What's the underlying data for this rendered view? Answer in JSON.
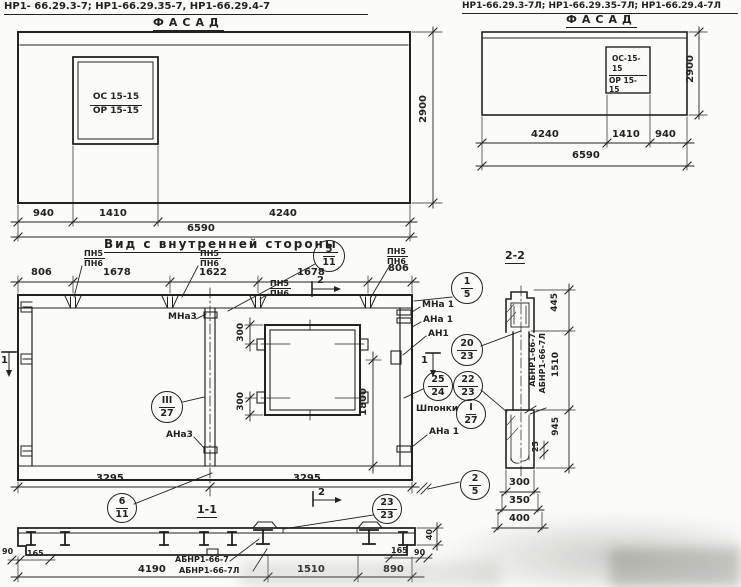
{
  "titles": {
    "left_marks": "НР1- 66.29.3-7;  НР1-66.29.35-7,  НР1-66.29.4-7",
    "right_marks": "НР1-66.29.3-7Л; НР1-66.29.35-7Л; НР1-66.29.4-7Л",
    "facade_left": "ФАСАД",
    "facade_right": "ФАСАД",
    "inner_view": "Вид с внутренней стороны",
    "section1": "1-1",
    "section2": "2-2"
  },
  "facade_left": {
    "window_line1": "ОС 15-15",
    "window_line2": "ОР 15-15",
    "dim_940": "940",
    "dim_1410": "1410",
    "dim_4240": "4240",
    "dim_total": "6590",
    "dim_height": "2900"
  },
  "facade_right": {
    "window_line1": "ОС-15-15",
    "window_line2": "ОР 15-15",
    "dim_4240": "4240",
    "dim_1410": "1410",
    "dim_940": "940",
    "dim_total": "6590",
    "dim_height": "2900"
  },
  "inner": {
    "top_dims": {
      "d1": "806",
      "d2": "1678",
      "d3": "1622",
      "d4": "1678",
      "d5": "806"
    },
    "pn": {
      "top": "ПН5",
      "bottom": "ПН6"
    },
    "bottom_dims": {
      "left": "3295",
      "right": "3295"
    },
    "dim300_top": "300",
    "dim300_bottom": "300",
    "dim1800": "1800",
    "labels": {
      "mna3": "МНа3",
      "ana3": "АНа3",
      "mna1": "МНа 1",
      "ana1": "АНа 1",
      "an1": "АН1",
      "shponki": "Шпонки",
      "ana1b": "АНа 1"
    },
    "sec_mark1": "1",
    "sec_mark2": "2"
  },
  "callouts": {
    "c5_11": {
      "t": "5",
      "b": "11"
    },
    "c1_5": {
      "t": "1",
      "b": "5"
    },
    "c20_23": {
      "t": "20",
      "b": "23"
    },
    "c25_24": {
      "t": "25",
      "b": "24"
    },
    "c22_23": {
      "t": "22",
      "b": "23"
    },
    "cI_27": {
      "t": "I",
      "b": "27"
    },
    "cIII_27": {
      "t": "III",
      "b": "27"
    },
    "c6_11": {
      "t": "6",
      "b": "11"
    },
    "c23_23": {
      "t": "23",
      "b": "23"
    },
    "c2_5": {
      "t": "2",
      "b": "5"
    }
  },
  "section1": {
    "label_a": "АБНР1-66-7",
    "label_b": "АБНР1-66-7Л",
    "dim_90l": "90",
    "dim_165l": "165",
    "dim_4190": "4190",
    "dim_1510": "1510",
    "dim_890": "890",
    "dim_165r": "165",
    "dim_90r": "90",
    "dim_40": "40"
  },
  "section2": {
    "label_a": "АБНР1-66-7",
    "label_b": "АБНР1-66-7Л",
    "dim_445": "445",
    "dim_1510": "1510",
    "dim_945": "945",
    "dim_25": "25",
    "dim_300": "300",
    "dim_350": "350",
    "dim_400": "400"
  }
}
